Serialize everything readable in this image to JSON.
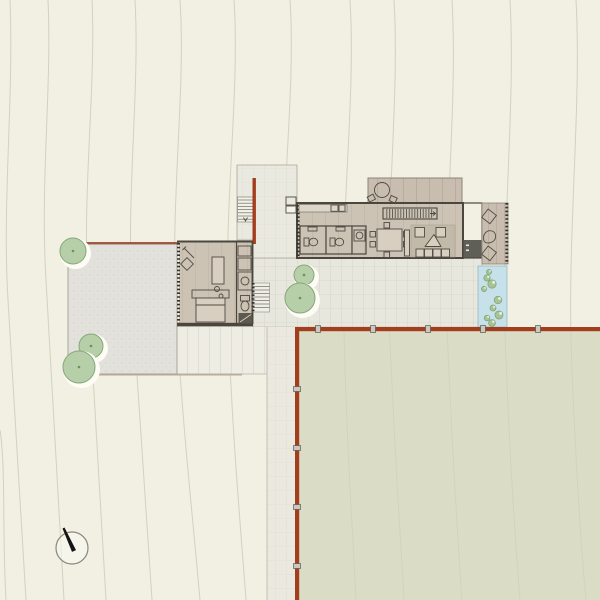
{
  "meta": {
    "type": "architectural-site-plan",
    "description": "Hillside house site plan: bedroom wing with walled courtyard, connecting spine walkway with red retaining walls, main living pavilion with roof terrace, pool and lower meadow",
    "canvas": {
      "width": 600,
      "height": 600
    },
    "visible_text": []
  },
  "palette": {
    "bg": "#f1f0e2",
    "contour": "#d2d2bf",
    "field": "#dbdcc6",
    "courtyard": "#e2e1dc",
    "patio": "#e8e7de",
    "platform": "#eae9e0",
    "deck": "#eeede4",
    "walkway": "#ebe9df",
    "interior": "#cdc3b4",
    "terrace": "#c8bdae",
    "wall": "#4b463e",
    "redwall": "#a23d1d",
    "redline": "#9a5a46",
    "pool": "#c6e1ea",
    "pooledge": "#9ab8c2",
    "treefill": "#b6cfa9",
    "treestroke": "#87a67b",
    "plantfill": "#a6c497",
    "plantstroke": "#7da06f",
    "fireplace_light": "#b2b5af",
    "fireplace_dark": "#5f5f57",
    "needle": "#141414"
  },
  "features": {
    "trees": [
      {
        "cx": 73,
        "cy": 251,
        "r": 13
      },
      {
        "cx": 91,
        "cy": 346,
        "r": 12
      },
      {
        "cx": 79,
        "cy": 367,
        "r": 16
      },
      {
        "cx": 304,
        "cy": 275,
        "r": 10
      },
      {
        "cx": 300,
        "cy": 298,
        "r": 15
      }
    ],
    "pool_plants": [
      {
        "x": 489,
        "y": 272,
        "r": 2.5
      },
      {
        "x": 487,
        "y": 278,
        "r": 3.2
      },
      {
        "x": 492,
        "y": 284,
        "r": 4.2
      },
      {
        "x": 484,
        "y": 289,
        "r": 2.6
      },
      {
        "x": 498,
        "y": 300,
        "r": 3.8
      },
      {
        "x": 493,
        "y": 308,
        "r": 3.0
      },
      {
        "x": 499,
        "y": 315,
        "r": 4.0
      },
      {
        "x": 487,
        "y": 318,
        "r": 2.8
      },
      {
        "x": 492,
        "y": 323,
        "r": 3.4
      }
    ],
    "wall_posts": {
      "horizontal_x": [
        318,
        373,
        428,
        483,
        538
      ],
      "vertical_y": [
        389,
        448,
        507,
        566
      ]
    },
    "north_arrow": {
      "cx": 72,
      "cy": 548,
      "r": 16
    }
  }
}
